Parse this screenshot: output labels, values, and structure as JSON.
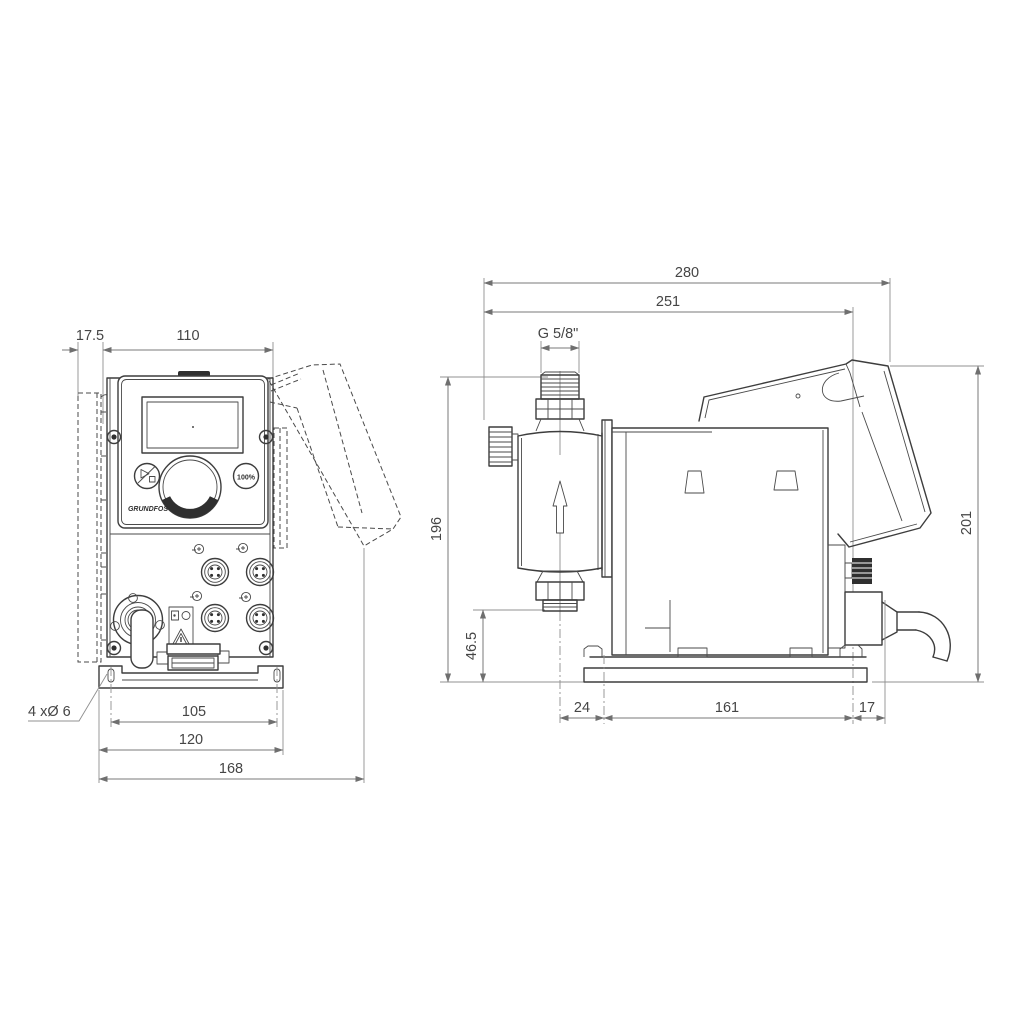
{
  "drawing": {
    "front_view": {
      "dim_offset": "17.5",
      "dim_width": "110",
      "dim_hole_span": "105",
      "dim_plate_width": "120",
      "dim_total_width": "168",
      "holes_label": "4 xØ 6",
      "panel": {
        "logo": "GRUNDFOS",
        "button_100": "100%"
      }
    },
    "side_view": {
      "dim_total_depth": "280",
      "dim_depth": "251",
      "thread_label": "G 5/8\"",
      "dim_height": "196",
      "dim_outlet_height": "46.5",
      "dim_hood_height": "201",
      "dim_foot_offset": "24",
      "dim_foot_span": "161",
      "dim_gland": "17"
    }
  }
}
